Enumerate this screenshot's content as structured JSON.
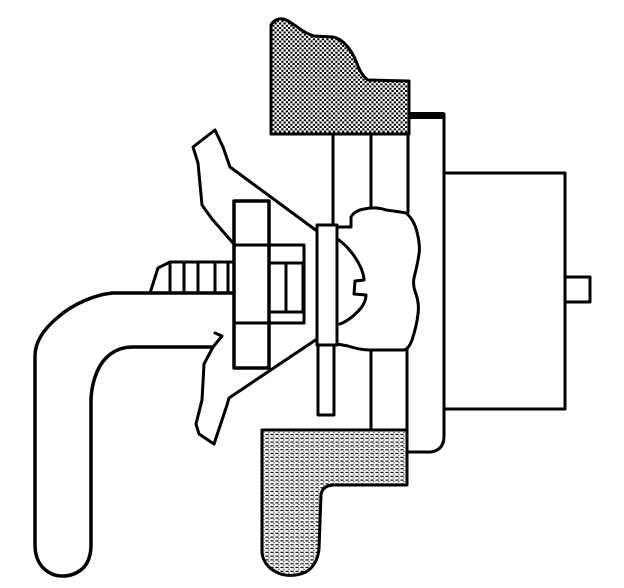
{
  "figure": {
    "kind": "technical-line-drawing",
    "canvas": {
      "width": 624,
      "height": 588
    },
    "colors": {
      "ink": "#000000",
      "paper": "#ffffff"
    },
    "shapes": [
      {
        "name": "top-bracket-flange",
        "fill": "dense",
        "sw": 3,
        "d": "M 271,25 C 273,21 278,18 283,19 C 288,20 291,23 296,26 C 301,30 307,34 314,36 L 333,37 C 343,39 351,49 356,61 C 359,69 362,76 368,80 L 409,81 L 409,134 L 271,134 Z"
      },
      {
        "name": "bottom-bracket-flange",
        "fill": "light",
        "sw": 3,
        "d": "M 262,430 L 407,430 L 407,485 L 333,485 Q 322,486 321,495 L 319,549 C 318,559 314,567 306,572 C 297,576 285,577 276,572 C 268,568 263,561 262,553 Z"
      },
      {
        "name": "mount-tab-top",
        "fill": "ink",
        "sw": 1,
        "d": "M 409,112 L 444,112 L 444,119 L 409,119 Z"
      },
      {
        "name": "mount-plate-line",
        "fill": "none",
        "sw": 3,
        "d": "M 444,114 L 444,436 Q 444,450 431,452 L 408,452"
      },
      {
        "name": "housing-body",
        "fill": "paper",
        "sw": 3,
        "d": "M 444,173 L 565,173 L 565,409 L 444,409 Z"
      },
      {
        "name": "housing-stub",
        "fill": "paper",
        "sw": 3,
        "d": "M 565,277 L 590,277 L 590,302 L 565,302 Z"
      },
      {
        "name": "handle-lever",
        "fill": "none",
        "sw": 3.5,
        "d": "M 234,293 L 112,293 C 95,295 74,303 57,318 C 44,329 35,342 35,356 L 35,545 C 35,559 41,569 52,574 C 62,578 74,576 82,569 C 88,564 91,555 91,545 L 91,401 C 91,389 95,369 106,358 C 114,350 124,347 133,347 L 213,347"
      },
      {
        "name": "ribbed-rod-outline",
        "fill": "none",
        "sw": 3,
        "d": "M 234,262 L 170,262 L 158,268 L 150,293"
      },
      {
        "name": "rod-rib-1",
        "fill": "none",
        "sw": 3,
        "d": "M 170,262 L 170,293"
      },
      {
        "name": "rod-rib-2",
        "fill": "none",
        "sw": 3,
        "d": "M 184,262 L 184,293"
      },
      {
        "name": "rod-rib-3",
        "fill": "none",
        "sw": 3,
        "d": "M 198,262 L 198,293"
      },
      {
        "name": "rod-rib-4",
        "fill": "none",
        "sw": 3,
        "d": "M 215,262 L 215,293"
      },
      {
        "name": "rod-rib-5",
        "fill": "none",
        "sw": 3,
        "d": "M 228,262 L 228,293"
      },
      {
        "name": "center-post",
        "fill": "none",
        "sw": 3.5,
        "d": "M 234,368 L 234,201 L 269,201 L 269,368 Z"
      },
      {
        "name": "center-flange",
        "fill": "none",
        "sw": 3,
        "d": "M 234,245 L 304,245 L 304,323 L 234,323 Z"
      },
      {
        "name": "nut-block",
        "fill": "none",
        "sw": 3,
        "d": "M 269,263 L 303,263 L 303,312 L 269,312 Z"
      },
      {
        "name": "nut-block-divider",
        "fill": "none",
        "sw": 3,
        "d": "M 286,263 L 286,312"
      },
      {
        "name": "yoke-upper-arm-left",
        "fill": "none",
        "sw": 3,
        "d": "M 215,130 L 193,147 L 198,163 L 202,205 L 212,219 L 233,243"
      },
      {
        "name": "yoke-upper-arm-right",
        "fill": "none",
        "sw": 3,
        "d": "M 215,130 L 223,147 L 230,167 L 317,231"
      },
      {
        "name": "yoke-lower-arm-left",
        "fill": "none",
        "sw": 3,
        "d": "M 215,333 L 222,336 L 213,347 L 204,364 L 202,400 L 196,424 L 199,434 L 214,444"
      },
      {
        "name": "yoke-lower-arm-right",
        "fill": "none",
        "sw": 3,
        "d": "M 214,444 L 227,405 L 229,398 L 317,339"
      },
      {
        "name": "grommet-profile",
        "fill": "paper",
        "sw": 3,
        "d": "M 337,227 L 351,227 L 351,217 C 353,213 358,210 364,209 C 374,207 380,208 386,210 C 394,211 401,212 406,213 C 411,217 415,224 417,232 C 419,240 420,248 419,254 C 418,262 416,270 414,278 C 413,283 414,289 416,294 C 418,300 419,307 418,314 C 417,323 415,331 412,340 C 410,345 408,349 404,350 L 370,350 C 362,350 354,348 348,346 L 337,344"
      },
      {
        "name": "grommet-inner-lobe",
        "fill": "none",
        "sw": 3,
        "d": "M 339,240 C 348,247 356,257 361,268 C 363,273 364,277 364,280 L 355,281 L 354,294 L 366,295 C 366,299 364,304 361,308 C 355,315 348,321 340,324"
      },
      {
        "name": "washer-plate",
        "fill": "paper",
        "sw": 3,
        "d": "M 317,225 L 337,225 L 337,345 L 317,345 Z"
      },
      {
        "name": "washer-stem",
        "fill": "paper",
        "sw": 3,
        "d": "M 318,345 L 334,345 L 334,415 L 318,415 Z"
      },
      {
        "name": "shaft-line-upper-1",
        "fill": "none",
        "sw": 3,
        "d": "M 333,134 L 333,225"
      },
      {
        "name": "shaft-line-upper-2",
        "fill": "none",
        "sw": 3,
        "d": "M 371,134 L 371,207"
      },
      {
        "name": "shaft-line-upper-3",
        "fill": "none",
        "sw": 3,
        "d": "M 408,134 L 408,212"
      },
      {
        "name": "shaft-line-lower-1",
        "fill": "none",
        "sw": 3,
        "d": "M 371,350 L 371,429"
      },
      {
        "name": "shaft-line-lower-2",
        "fill": "none",
        "sw": 3,
        "d": "M 407,349 L 407,429"
      }
    ]
  }
}
